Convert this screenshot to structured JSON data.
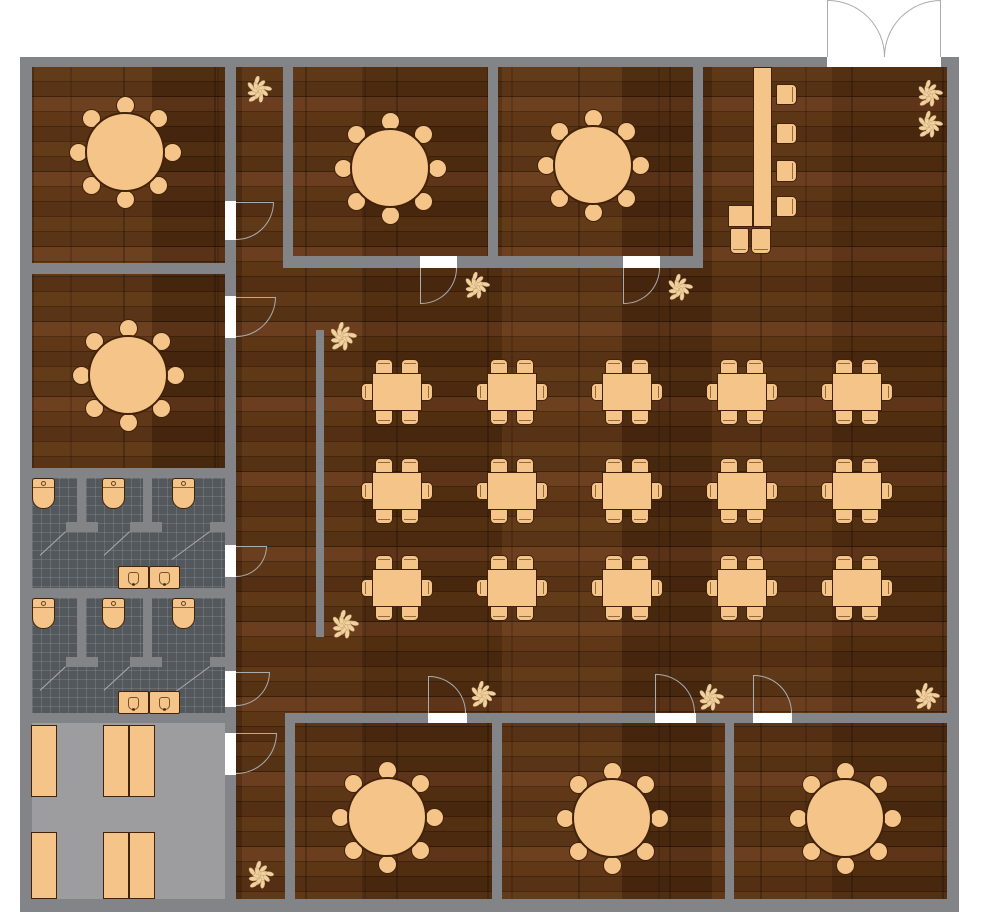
{
  "app": {
    "type": "floor-plan",
    "subject": "restaurant-floor-plan"
  },
  "canvas": {
    "width": 1000,
    "height": 914,
    "background": "#ffffff"
  },
  "palette": {
    "wall": "#828488",
    "wood_floor": "#4c2a10",
    "tile_floor": "#53585d",
    "kitchen_floor": "#9d9da0",
    "furniture_fill": "#f5c488",
    "furniture_border": "#42230a",
    "door_line": "#a9adae",
    "plant_leaf": "#f0d2a2",
    "plant_stroke": "#c9a068",
    "white": "#ffffff"
  },
  "inventory": {
    "round_tables_8_seat": 7,
    "dining_tables_6_seat": 15,
    "bar_counters": 1,
    "bar_stools": 6,
    "toilets": 6,
    "toilet_stalls": 6,
    "sink_units": 4,
    "kitchen_shelves": 6,
    "plants": 11,
    "double_entry_doors": 1,
    "interior_doors": 10
  },
  "floors": [
    {
      "name": "main-dining-floor",
      "kind": "wood",
      "x": 32,
      "y": 67,
      "w": 915,
      "h": 832
    },
    {
      "name": "restroom-1-floor",
      "kind": "tile",
      "x": 32,
      "y": 478,
      "w": 193,
      "h": 110
    },
    {
      "name": "restroom-2-floor",
      "kind": "tile",
      "x": 32,
      "y": 598,
      "w": 193,
      "h": 115
    },
    {
      "name": "kitchen-floor",
      "kind": "plain",
      "x": 32,
      "y": 723,
      "w": 193,
      "h": 176
    }
  ],
  "walls": [
    {
      "name": "outer-wall-top-left",
      "x": 20,
      "y": 57,
      "w": 807,
      "h": 10
    },
    {
      "name": "outer-wall-top-right",
      "x": 941,
      "y": 57,
      "w": 18,
      "h": 10
    },
    {
      "name": "outer-wall-left",
      "x": 20,
      "y": 57,
      "w": 12,
      "h": 855
    },
    {
      "name": "outer-wall-right",
      "x": 947,
      "y": 57,
      "w": 12,
      "h": 855
    },
    {
      "name": "outer-wall-bottom",
      "x": 20,
      "y": 899,
      "w": 939,
      "h": 13
    },
    {
      "name": "corridor-wall-1",
      "x": 225,
      "y": 67,
      "w": 11,
      "h": 134
    },
    {
      "name": "corridor-wall-2",
      "x": 225,
      "y": 240,
      "w": 11,
      "h": 56
    },
    {
      "name": "corridor-wall-3",
      "x": 225,
      "y": 338,
      "w": 11,
      "h": 207
    },
    {
      "name": "corridor-wall-4",
      "x": 225,
      "y": 577,
      "w": 11,
      "h": 94
    },
    {
      "name": "corridor-wall-5",
      "x": 225,
      "y": 707,
      "w": 11,
      "h": 26
    },
    {
      "name": "corridor-wall-6",
      "x": 225,
      "y": 775,
      "w": 11,
      "h": 124
    },
    {
      "name": "topleft-room-south-wall",
      "x": 20,
      "y": 263,
      "w": 216,
      "h": 11
    },
    {
      "name": "midleft-room-south-wall",
      "x": 20,
      "y": 468,
      "w": 216,
      "h": 10
    },
    {
      "name": "restroom-divider-wall",
      "x": 20,
      "y": 588,
      "w": 216,
      "h": 10
    },
    {
      "name": "kitchen-north-wall",
      "x": 20,
      "y": 713,
      "w": 216,
      "h": 10
    },
    {
      "name": "room-a-west-wall",
      "x": 283,
      "y": 67,
      "w": 10,
      "h": 189
    },
    {
      "name": "room-ab-south-wall-1",
      "x": 283,
      "y": 256,
      "w": 137,
      "h": 12
    },
    {
      "name": "room-ab-south-wall-2",
      "x": 457,
      "y": 256,
      "w": 166,
      "h": 12
    },
    {
      "name": "room-ab-south-wall-3",
      "x": 660,
      "y": 256,
      "w": 43,
      "h": 12
    },
    {
      "name": "room-ab-divider-wall",
      "x": 488,
      "y": 67,
      "w": 10,
      "h": 189
    },
    {
      "name": "room-b-east-wall",
      "x": 693,
      "y": 67,
      "w": 10,
      "h": 201
    },
    {
      "name": "dining-screen-wall",
      "x": 316,
      "y": 330,
      "w": 8,
      "h": 307
    },
    {
      "name": "bottom-rooms-north-wall-1",
      "x": 287,
      "y": 713,
      "w": 141,
      "h": 10
    },
    {
      "name": "bottom-rooms-north-wall-2",
      "x": 467,
      "y": 713,
      "w": 188,
      "h": 10
    },
    {
      "name": "bottom-rooms-north-wall-3",
      "x": 696,
      "y": 713,
      "w": 57,
      "h": 10
    },
    {
      "name": "bottom-rooms-north-wall-4",
      "x": 792,
      "y": 713,
      "w": 155,
      "h": 10
    },
    {
      "name": "room-1-west-wall",
      "x": 285,
      "y": 713,
      "w": 10,
      "h": 186
    },
    {
      "name": "room-12-divider-wall",
      "x": 492,
      "y": 723,
      "w": 10,
      "h": 176
    },
    {
      "name": "room-23-divider-wall",
      "x": 725,
      "y": 723,
      "w": 9,
      "h": 176
    },
    {
      "name": "r1-stall-divider-1",
      "x": 77,
      "y": 478,
      "w": 9,
      "h": 54
    },
    {
      "name": "r1-stall-divider-2",
      "x": 143,
      "y": 478,
      "w": 9,
      "h": 54
    },
    {
      "name": "r1-stall-front-1",
      "x": 66,
      "y": 522,
      "w": 32,
      "h": 10
    },
    {
      "name": "r1-stall-front-2",
      "x": 130,
      "y": 522,
      "w": 32,
      "h": 10
    },
    {
      "name": "r1-stall-front-3",
      "x": 210,
      "y": 522,
      "w": 26,
      "h": 10
    },
    {
      "name": "r2-stall-divider-1",
      "x": 77,
      "y": 598,
      "w": 9,
      "h": 69
    },
    {
      "name": "r2-stall-divider-2",
      "x": 143,
      "y": 598,
      "w": 9,
      "h": 69
    },
    {
      "name": "r2-stall-front-1",
      "x": 66,
      "y": 657,
      "w": 32,
      "h": 10
    },
    {
      "name": "r2-stall-front-2",
      "x": 130,
      "y": 657,
      "w": 32,
      "h": 10
    },
    {
      "name": "r2-stall-front-3",
      "x": 210,
      "y": 657,
      "w": 26,
      "h": 10
    }
  ],
  "door_gaps": [
    {
      "x": 827,
      "y": 57,
      "w": 114,
      "h": 10
    },
    {
      "x": 225,
      "y": 201,
      "w": 11,
      "h": 39
    },
    {
      "x": 225,
      "y": 296,
      "w": 11,
      "h": 42
    },
    {
      "x": 225,
      "y": 545,
      "w": 11,
      "h": 32
    },
    {
      "x": 225,
      "y": 671,
      "w": 11,
      "h": 36
    },
    {
      "x": 225,
      "y": 733,
      "w": 11,
      "h": 42
    },
    {
      "x": 420,
      "y": 256,
      "w": 37,
      "h": 12
    },
    {
      "x": 623,
      "y": 256,
      "w": 37,
      "h": 12
    },
    {
      "x": 428,
      "y": 713,
      "w": 39,
      "h": 10
    },
    {
      "x": 655,
      "y": 713,
      "w": 41,
      "h": 10
    },
    {
      "x": 753,
      "y": 713,
      "w": 39,
      "h": 10
    }
  ],
  "doors": [
    {
      "name": "entry-door-left-leaf",
      "arc": {
        "x": 828,
        "y": 0,
        "r": 57,
        "corner": "tr"
      },
      "leaf": {
        "x1": 828,
        "y1": 0,
        "x2": 828,
        "y2": 57
      }
    },
    {
      "name": "entry-door-right-leaf",
      "arc": {
        "x": 884,
        "y": 0,
        "r": 57,
        "corner": "tl"
      },
      "leaf": {
        "x1": 941,
        "y1": 0,
        "x2": 941,
        "y2": 57
      }
    },
    {
      "name": "topleft-room-door",
      "arc": {
        "x": 236,
        "y": 202,
        "r": 38,
        "corner": "br"
      },
      "leaf": {
        "x1": 236,
        "y1": 202,
        "x2": 274,
        "y2": 202
      }
    },
    {
      "name": "midleft-room-door",
      "arc": {
        "x": 236,
        "y": 297,
        "r": 40,
        "corner": "br"
      },
      "leaf": {
        "x1": 236,
        "y1": 297,
        "x2": 276,
        "y2": 297
      }
    },
    {
      "name": "restroom-1-door",
      "arc": {
        "x": 236,
        "y": 546,
        "r": 31,
        "corner": "br"
      },
      "leaf": {
        "x1": 236,
        "y1": 546,
        "x2": 267,
        "y2": 546
      }
    },
    {
      "name": "restroom-2-door",
      "arc": {
        "x": 236,
        "y": 672,
        "r": 34,
        "corner": "br"
      },
      "leaf": {
        "x1": 236,
        "y1": 672,
        "x2": 270,
        "y2": 672
      }
    },
    {
      "name": "kitchen-door",
      "arc": {
        "x": 236,
        "y": 733,
        "r": 41,
        "corner": "br"
      },
      "leaf": {
        "x1": 236,
        "y1": 733,
        "x2": 277,
        "y2": 733
      }
    },
    {
      "name": "room-a-door",
      "arc": {
        "x": 421,
        "y": 268,
        "r": 36,
        "corner": "br"
      },
      "leaf": {
        "x1": 421,
        "y1": 268,
        "x2": 421,
        "y2": 304
      }
    },
    {
      "name": "room-b-door",
      "arc": {
        "x": 624,
        "y": 268,
        "r": 36,
        "corner": "br"
      },
      "leaf": {
        "x1": 624,
        "y1": 268,
        "x2": 624,
        "y2": 304
      }
    },
    {
      "name": "room-1-door",
      "arc": {
        "x": 429,
        "y": 676,
        "r": 37,
        "corner": "tr"
      },
      "leaf": {
        "x1": 429,
        "y1": 676,
        "x2": 429,
        "y2": 713
      }
    },
    {
      "name": "room-2-door",
      "arc": {
        "x": 656,
        "y": 674,
        "r": 39,
        "corner": "tr"
      },
      "leaf": {
        "x1": 656,
        "y1": 674,
        "x2": 656,
        "y2": 713
      }
    },
    {
      "name": "room-3-door",
      "arc": {
        "x": 754,
        "y": 675,
        "r": 38,
        "corner": "tr"
      },
      "leaf": {
        "x1": 754,
        "y1": 675,
        "x2": 754,
        "y2": 713
      }
    }
  ],
  "stall_door_lines": [
    {
      "x1": 66,
      "y1": 532,
      "x2": 40,
      "y2": 556
    },
    {
      "x1": 130,
      "y1": 532,
      "x2": 104,
      "y2": 556
    },
    {
      "x1": 210,
      "y1": 532,
      "x2": 172,
      "y2": 560
    },
    {
      "x1": 66,
      "y1": 667,
      "x2": 40,
      "y2": 691
    },
    {
      "x1": 130,
      "y1": 667,
      "x2": 104,
      "y2": 691
    },
    {
      "x1": 210,
      "y1": 667,
      "x2": 172,
      "y2": 695
    }
  ],
  "round_tables": [
    {
      "name": "private-room-nw-table",
      "cx": 125,
      "cy": 152
    },
    {
      "name": "private-room-w-table",
      "cx": 128,
      "cy": 375
    },
    {
      "name": "private-room-a-table",
      "cx": 390,
      "cy": 168
    },
    {
      "name": "private-room-b-table",
      "cx": 593,
      "cy": 165
    },
    {
      "name": "private-room-s1-table",
      "cx": 387,
      "cy": 817
    },
    {
      "name": "private-room-s2-table",
      "cx": 612,
      "cy": 818
    },
    {
      "name": "private-room-s3-table",
      "cx": 845,
      "cy": 818
    }
  ],
  "dining_area": {
    "columns_x": [
      397,
      512,
      627,
      742,
      857
    ],
    "rows_y": [
      392,
      491,
      588
    ],
    "table_w": 50,
    "table_h": 38,
    "seats_per_table": 6
  },
  "bar": {
    "counters": [
      {
        "name": "bar-counter-main",
        "x": 753,
        "y": 67,
        "w": 19,
        "h": 160
      },
      {
        "name": "bar-counter-foot",
        "x": 728,
        "y": 205,
        "w": 25,
        "h": 22
      }
    ],
    "stools": [
      {
        "x": 776,
        "y": 84,
        "w": 21,
        "h": 21,
        "face": "right"
      },
      {
        "x": 776,
        "y": 123,
        "w": 21,
        "h": 21,
        "face": "right"
      },
      {
        "x": 776,
        "y": 160,
        "w": 21,
        "h": 22,
        "face": "right"
      },
      {
        "x": 776,
        "y": 196,
        "w": 21,
        "h": 21,
        "face": "right"
      },
      {
        "x": 730,
        "y": 228,
        "w": 19,
        "h": 26,
        "face": "bottom"
      },
      {
        "x": 751,
        "y": 228,
        "w": 20,
        "h": 26,
        "face": "bottom"
      }
    ]
  },
  "restrooms": {
    "toilets": [
      {
        "x": 32,
        "y": 478
      },
      {
        "x": 102,
        "y": 478
      },
      {
        "x": 172,
        "y": 478
      },
      {
        "x": 32,
        "y": 598
      },
      {
        "x": 102,
        "y": 598
      },
      {
        "x": 172,
        "y": 598
      }
    ],
    "sink_units": [
      {
        "x": 118,
        "y": 566
      },
      {
        "x": 149,
        "y": 566
      },
      {
        "x": 118,
        "y": 691
      },
      {
        "x": 149,
        "y": 691
      }
    ]
  },
  "kitchen": {
    "shelves": [
      {
        "x": 31,
        "y": 725,
        "w": 26,
        "h": 72
      },
      {
        "x": 103,
        "y": 725,
        "w": 26,
        "h": 72
      },
      {
        "x": 129,
        "y": 725,
        "w": 26,
        "h": 72
      },
      {
        "x": 31,
        "y": 832,
        "w": 26,
        "h": 67
      },
      {
        "x": 103,
        "y": 832,
        "w": 26,
        "h": 67
      },
      {
        "x": 129,
        "y": 832,
        "w": 26,
        "h": 67
      }
    ]
  },
  "plants": [
    {
      "x": 244,
      "y": 76,
      "s": 29
    },
    {
      "x": 915,
      "y": 80,
      "s": 29
    },
    {
      "x": 915,
      "y": 111,
      "s": 29
    },
    {
      "x": 462,
      "y": 272,
      "s": 29
    },
    {
      "x": 665,
      "y": 274,
      "s": 29
    },
    {
      "x": 327,
      "y": 322,
      "s": 31
    },
    {
      "x": 329,
      "y": 610,
      "s": 31
    },
    {
      "x": 468,
      "y": 681,
      "s": 29
    },
    {
      "x": 696,
      "y": 684,
      "s": 29
    },
    {
      "x": 912,
      "y": 683,
      "s": 29
    },
    {
      "x": 245,
      "y": 861,
      "s": 30
    }
  ]
}
